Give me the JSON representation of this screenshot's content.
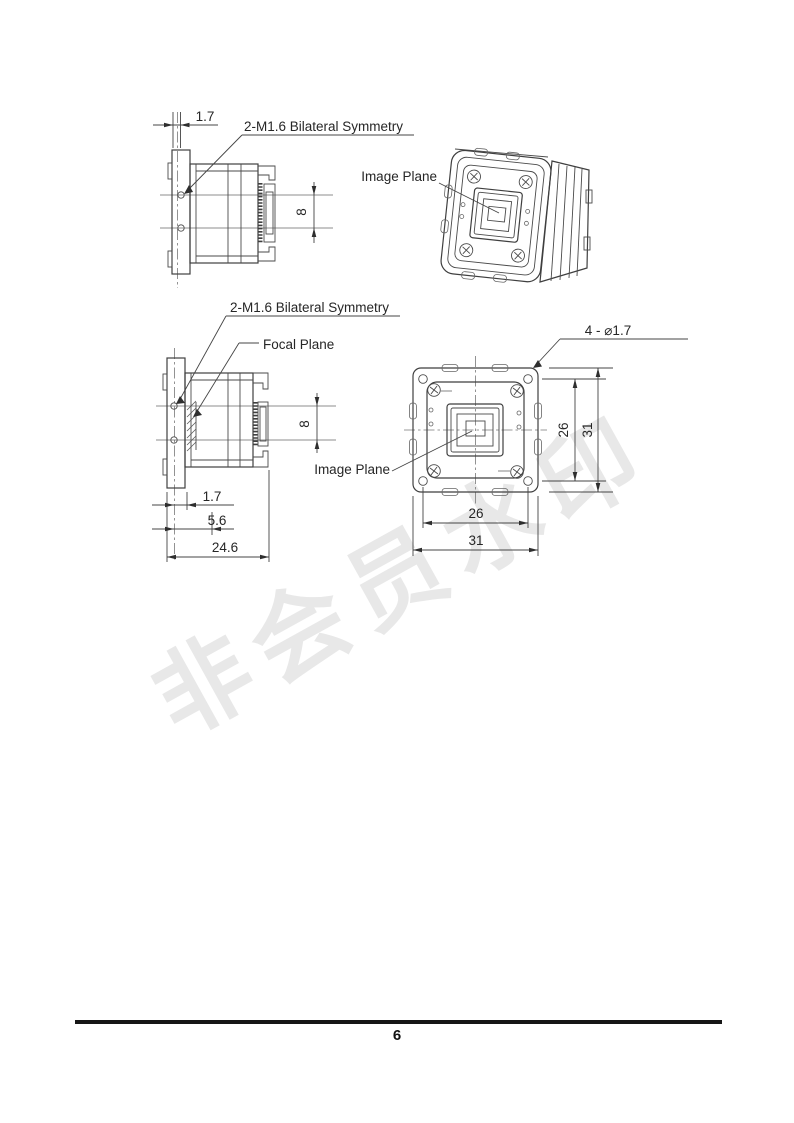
{
  "watermark": {
    "text": "非会员水印",
    "color": "#e8e8e8"
  },
  "footer": {
    "page_number": "6"
  },
  "style": {
    "line_color": "#3f3f3f",
    "text_color": "#262626",
    "background": "#ffffff"
  },
  "drawings": {
    "side_view_top": {
      "dim_flange_thickness": "1.7",
      "label_screw_holes": "2-M1.6 Bilateral Symmetry",
      "dim_connector_height": "8"
    },
    "iso_view": {
      "label_image_plane": "Image Plane"
    },
    "side_view_mid": {
      "label_screw_holes": "2-M1.6 Bilateral Symmetry",
      "label_focal_plane": "Focal Plane",
      "dim_connector_height": "8",
      "label_image_plane": "Image Plane",
      "dim_flange_thickness": "1.7",
      "dim_focal_depth": "5.6",
      "dim_total_depth": "24.6"
    },
    "front_view": {
      "label_mounting_holes": "4 - ⌀1.7",
      "dim_hole_spacing_vertical": "26",
      "dim_body_height": "31",
      "dim_hole_spacing_horizontal": "26",
      "dim_body_width": "31"
    }
  }
}
